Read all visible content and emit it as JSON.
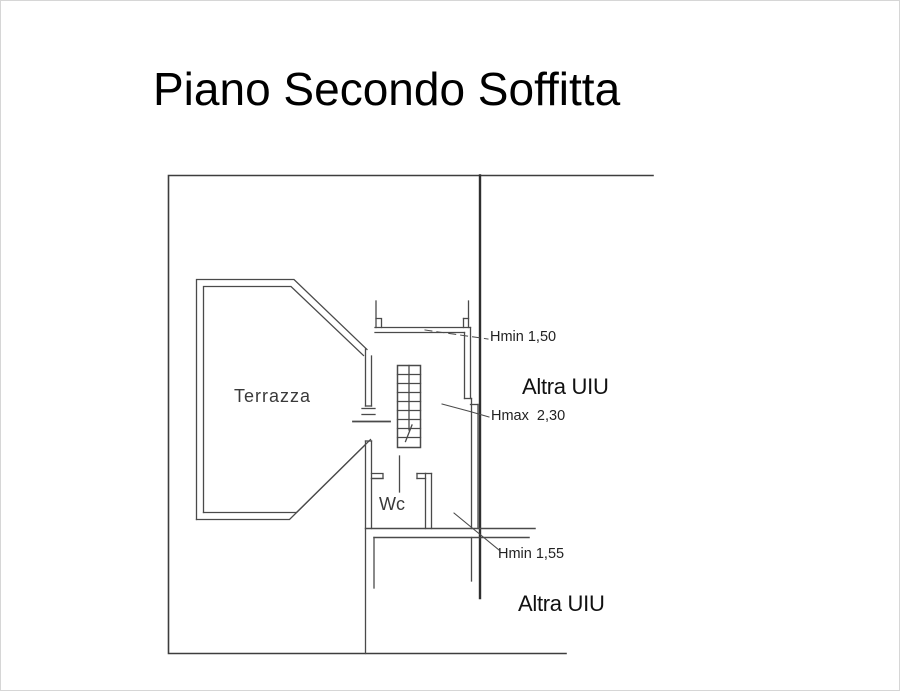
{
  "title": "Piano Secondo Soffitta",
  "plan": {
    "floor": "Piano Secondo",
    "zone": "Soffitta",
    "rooms": {
      "terrace_label": "Terrazza",
      "wc_label": "Wc"
    },
    "adjacent_units": {
      "upper_label": "Altra UIU",
      "lower_label": "Altra UIU"
    },
    "height_annotations": [
      {
        "id": "hmin_150",
        "text": "Hmin 1,50"
      },
      {
        "id": "hmax_230",
        "text": "Hmax  2,30"
      },
      {
        "id": "hmin_155",
        "text": "Hmin 1,55"
      }
    ]
  },
  "colors": {
    "background": "#ffffff",
    "wall_line": "#4a4a4a",
    "boundary_line": "#2f2f2f",
    "text": "#1a1a1a",
    "frame": "#d6d6d6"
  }
}
